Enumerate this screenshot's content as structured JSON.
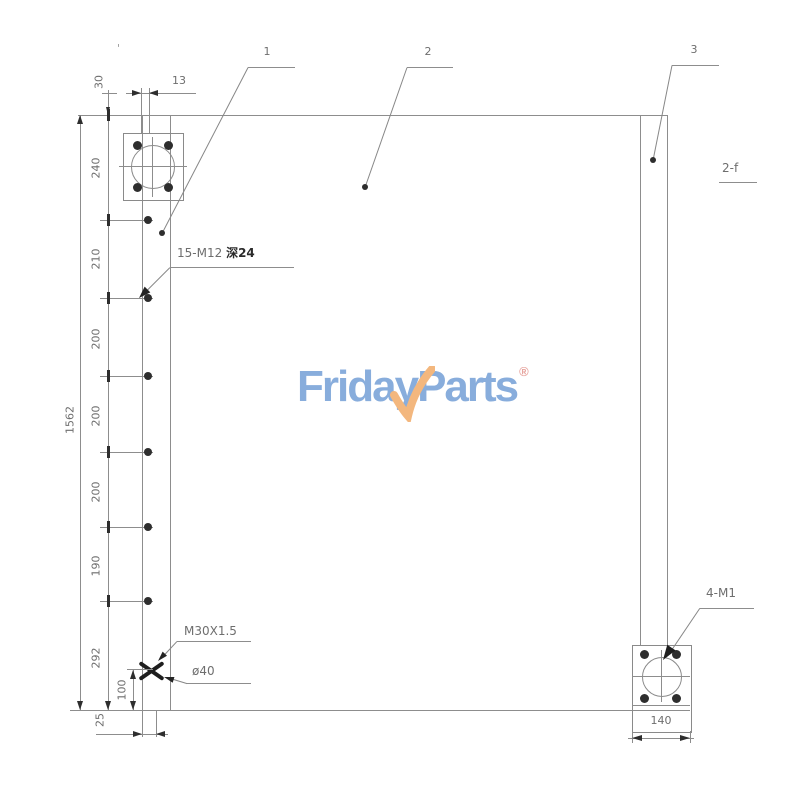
{
  "logo": {
    "frida": "Frida",
    "y": "y",
    "parts": "Parts",
    "reg": "®",
    "blue": "#88ADDC",
    "orange": "#F3B77E"
  },
  "callouts": {
    "c1": "1",
    "c2": "2",
    "c3": "3",
    "section_note": "2-f",
    "holes_prefix": "15-M12",
    "holes_depth": "深24",
    "port_thread": "M30X1.5",
    "port_diameter": "ø40",
    "flange_holes": "4-M1",
    "tick_mark": "'"
  },
  "dims": {
    "overall": "1562",
    "top_stub": "30",
    "stub_width": "13",
    "chain": [
      "240",
      "210",
      "200",
      "200",
      "200",
      "190",
      "292"
    ],
    "port_bottom": "100",
    "bottom": "25",
    "flange_width": "140"
  }
}
